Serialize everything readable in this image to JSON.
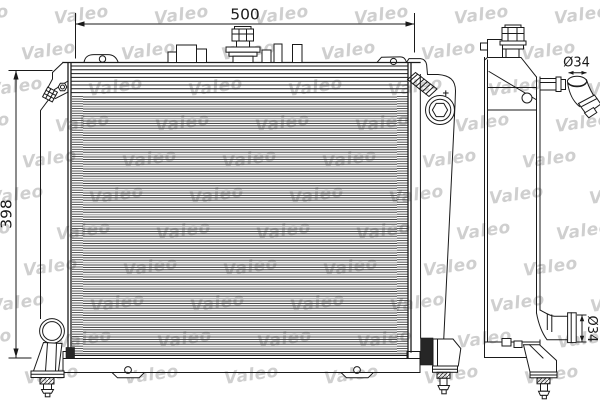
{
  "watermark": {
    "text": "Valeo",
    "color": "#8f8f8f",
    "opacity": 0.42
  },
  "dimensions": {
    "width": "500",
    "height": "398",
    "inlet_diameter": "Ø34",
    "outlet_diameter": "Ø34"
  },
  "annotations": {
    "plus_mark": "+"
  },
  "colors": {
    "line": "#1a1a1a",
    "background": "#ffffff",
    "rubber_pad": "#262626"
  }
}
